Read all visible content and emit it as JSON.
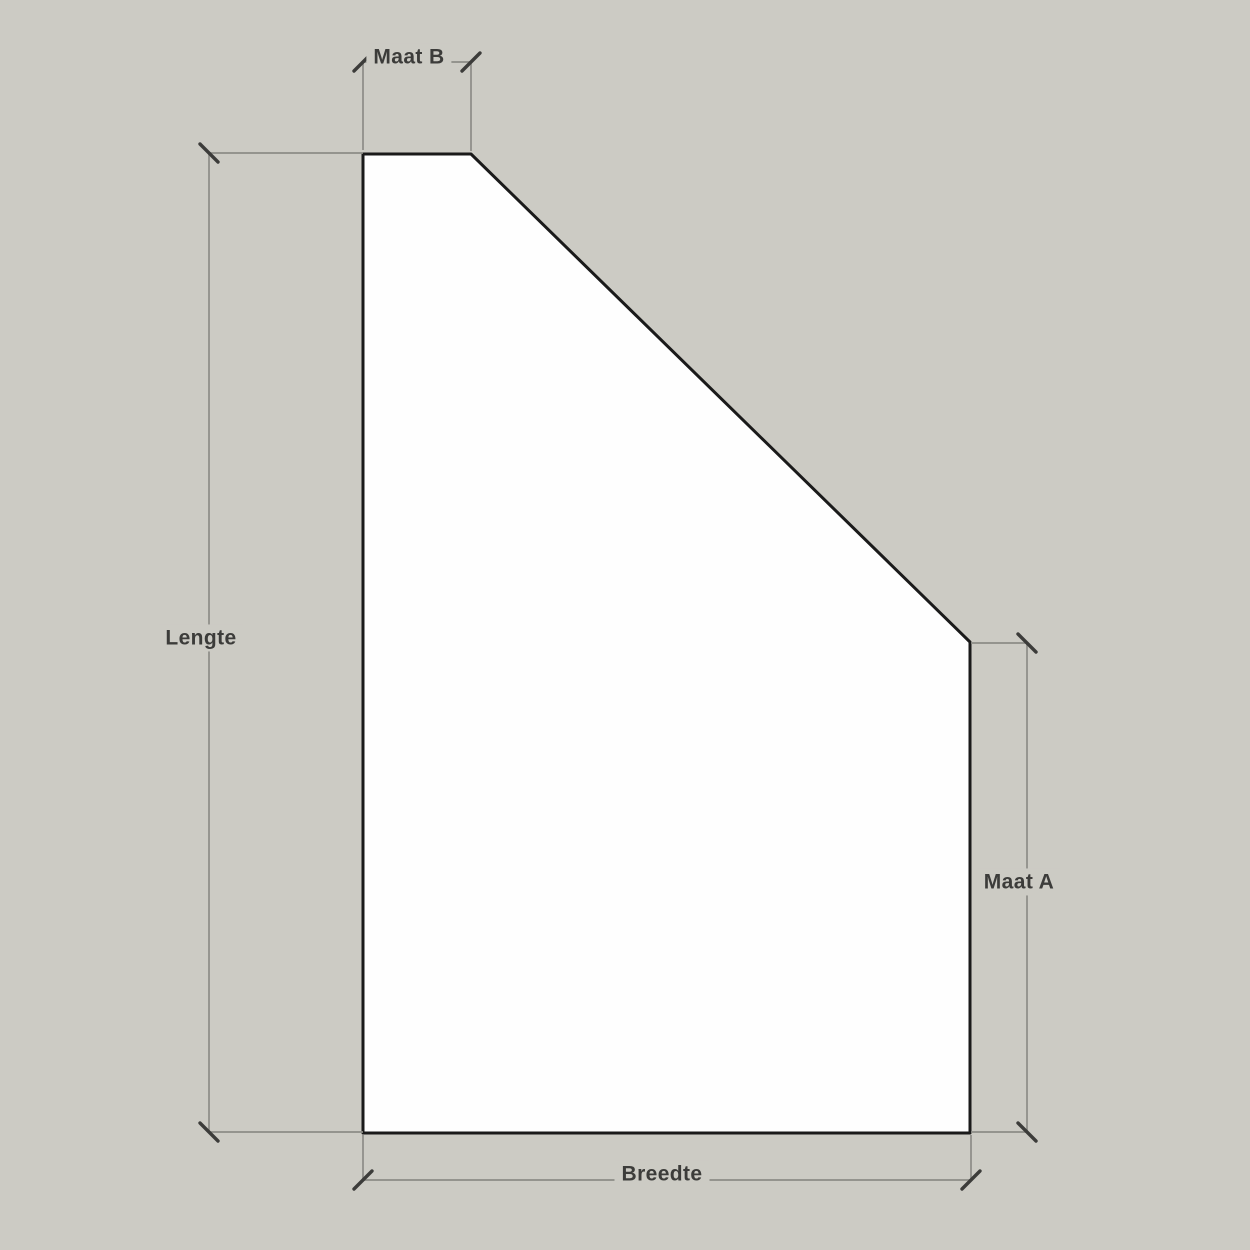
{
  "diagram": {
    "description": "Dimension drawing of a panel with a beveled top-right corner",
    "colors": {
      "background": "#cccbc4",
      "shape_fill": "#fefefe",
      "shape_outline": "#1a1a1a",
      "dimension_line": "#8c8c87",
      "tick": "#3c3c3a",
      "label_text": "#3c3c3a"
    },
    "shape": {
      "type": "polygon",
      "points": [
        [
          363,
          154
        ],
        [
          471,
          154
        ],
        [
          970,
          642
        ],
        [
          970,
          1133
        ],
        [
          363,
          1133
        ]
      ],
      "outline_width": 3
    },
    "dimension_lines": [
      {
        "name": "maat-b-left-extension",
        "x1": 363,
        "y1": 62,
        "x2": 363,
        "y2": 150
      },
      {
        "name": "maat-b-right-extension",
        "x1": 471,
        "y1": 62,
        "x2": 471,
        "y2": 151
      },
      {
        "name": "maat-b-main",
        "x1": 363,
        "y1": 62,
        "x2": 471,
        "y2": 62
      },
      {
        "name": "lengte-top-extension",
        "x1": 209,
        "y1": 153,
        "x2": 363,
        "y2": 153
      },
      {
        "name": "lengte-bottom-extension",
        "x1": 209,
        "y1": 1132,
        "x2": 363,
        "y2": 1132
      },
      {
        "name": "lengte-main",
        "x1": 209,
        "y1": 153,
        "x2": 209,
        "y2": 1132
      },
      {
        "name": "maat-a-top-extension",
        "x1": 971,
        "y1": 643,
        "x2": 1027,
        "y2": 643
      },
      {
        "name": "maat-a-bottom-extension",
        "x1": 971,
        "y1": 1132,
        "x2": 1027,
        "y2": 1132
      },
      {
        "name": "maat-a-main",
        "x1": 1027,
        "y1": 643,
        "x2": 1027,
        "y2": 1132
      },
      {
        "name": "breedte-left-extension",
        "x1": 363,
        "y1": 1135,
        "x2": 363,
        "y2": 1180
      },
      {
        "name": "breedte-right-extension",
        "x1": 971,
        "y1": 1135,
        "x2": 971,
        "y2": 1180
      },
      {
        "name": "breedte-main",
        "x1": 363,
        "y1": 1180,
        "x2": 971,
        "y2": 1180
      }
    ],
    "ticks": [
      {
        "name": "tick-maat-b-left",
        "x": 363,
        "y": 62,
        "dir": "up-right"
      },
      {
        "name": "tick-maat-b-right",
        "x": 471,
        "y": 62,
        "dir": "up-right"
      },
      {
        "name": "tick-lengte-top",
        "x": 209,
        "y": 153,
        "dir": "down-right"
      },
      {
        "name": "tick-lengte-bottom",
        "x": 209,
        "y": 1132,
        "dir": "down-right"
      },
      {
        "name": "tick-maat-a-top",
        "x": 1027,
        "y": 643,
        "dir": "down-right"
      },
      {
        "name": "tick-maat-a-bottom",
        "x": 1027,
        "y": 1132,
        "dir": "down-right"
      },
      {
        "name": "tick-breedte-left",
        "x": 363,
        "y": 1180,
        "dir": "up-right"
      },
      {
        "name": "tick-breedte-right",
        "x": 971,
        "y": 1180,
        "dir": "up-right"
      }
    ],
    "tick_half_length": 9,
    "labels": {
      "maat_b": {
        "text": "Maat B",
        "x": 409,
        "y": 57
      },
      "lengte": {
        "text": "Lengte",
        "x": 201,
        "y": 638
      },
      "maat_a": {
        "text": "Maat A",
        "x": 1019,
        "y": 882
      },
      "breedte": {
        "text": "Breedte",
        "x": 662,
        "y": 1174
      }
    }
  }
}
